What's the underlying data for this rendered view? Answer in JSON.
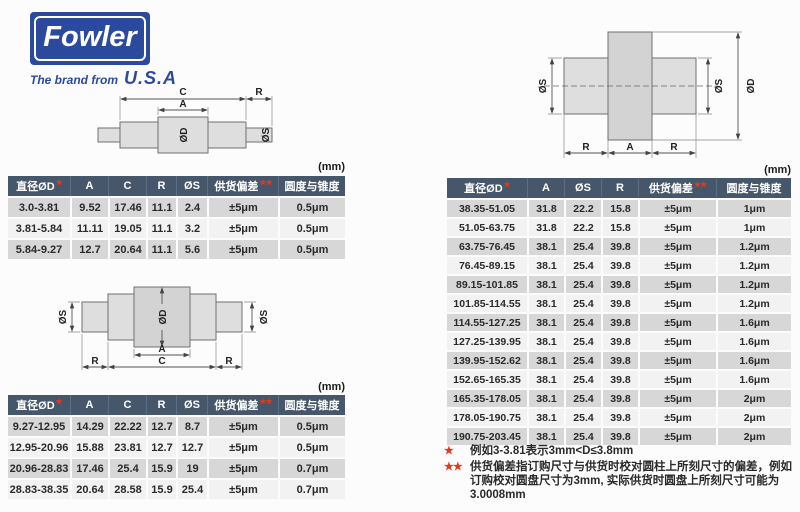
{
  "logo": {
    "brand": "Fowler",
    "tagline_prefix": "The brand from",
    "tagline_suffix": "U.S.A"
  },
  "colors": {
    "logo_blue": "#2b4a9e",
    "table_header_slate": "#46566b",
    "row_gray": "#d7d7d7",
    "row_light": "#f2f2f2",
    "star_red": "#e03a1e"
  },
  "diagrams": {
    "side_small": {
      "labels": {
        "C": "C",
        "A": "A",
        "R": "R",
        "OD": "ØD",
        "OS": "ØS"
      }
    },
    "side_large": {
      "labels": {
        "A": "A",
        "C": "C",
        "R_left": "R",
        "R_right": "R",
        "OD": "ØD",
        "OS_left": "ØS",
        "OS_right": "ØS"
      }
    },
    "front": {
      "labels": {
        "R_left": "R",
        "A": "A",
        "R_right": "R",
        "OD": "ØD",
        "OS_left": "ØS",
        "OS_right": "ØS"
      }
    }
  },
  "tables": {
    "small_upper": {
      "units": "(mm)",
      "headers": [
        {
          "label": "直径ØD",
          "stars": 1
        },
        {
          "label": "A",
          "stars": 0
        },
        {
          "label": "C",
          "stars": 0
        },
        {
          "label": "R",
          "stars": 0
        },
        {
          "label": "ØS",
          "stars": 0
        },
        {
          "label": "供货偏差",
          "stars": 2
        },
        {
          "label": "圆度与锥度",
          "stars": 0
        }
      ],
      "rows": [
        [
          "3.0-3.81",
          "9.52",
          "17.46",
          "11.1",
          "2.4",
          "±5μm",
          "0.5μm"
        ],
        [
          "3.81-5.84",
          "11.11",
          "19.05",
          "11.1",
          "3.2",
          "±5μm",
          "0.5μm"
        ],
        [
          "5.84-9.27",
          "12.7",
          "20.64",
          "11.1",
          "5.6",
          "±5μm",
          "0.5μm"
        ]
      ]
    },
    "small_lower": {
      "units": "(mm)",
      "headers": [
        {
          "label": "直径ØD",
          "stars": 1
        },
        {
          "label": "A",
          "stars": 0
        },
        {
          "label": "C",
          "stars": 0
        },
        {
          "label": "R",
          "stars": 0
        },
        {
          "label": "ØS",
          "stars": 0
        },
        {
          "label": "供货偏差",
          "stars": 2
        },
        {
          "label": "圆度与锥度",
          "stars": 0
        }
      ],
      "rows": [
        [
          "9.27-12.95",
          "14.29",
          "22.22",
          "12.7",
          "8.7",
          "±5μm",
          "0.5μm"
        ],
        [
          "12.95-20.96",
          "15.88",
          "23.81",
          "12.7",
          "12.7",
          "±5μm",
          "0.5μm"
        ],
        [
          "20.96-28.83",
          "17.46",
          "25.4",
          "15.9",
          "19",
          "±5μm",
          "0.7μm"
        ],
        [
          "28.83-38.35",
          "20.64",
          "28.58",
          "15.9",
          "25.4",
          "±5μm",
          "0.7μm"
        ]
      ]
    },
    "large_right": {
      "units": "(mm)",
      "headers": [
        {
          "label": "直径ØD",
          "stars": 1
        },
        {
          "label": "A",
          "stars": 0
        },
        {
          "label": "ØS",
          "stars": 0
        },
        {
          "label": "R",
          "stars": 0
        },
        {
          "label": "供货偏差",
          "stars": 2
        },
        {
          "label": "圆度与锥度",
          "stars": 0
        }
      ],
      "rows": [
        [
          "38.35-51.05",
          "31.8",
          "22.2",
          "15.8",
          "±5μm",
          "1μm"
        ],
        [
          "51.05-63.75",
          "31.8",
          "22.2",
          "15.8",
          "±5μm",
          "1μm"
        ],
        [
          "63.75-76.45",
          "38.1",
          "25.4",
          "39.8",
          "±5μm",
          "1.2μm"
        ],
        [
          "76.45-89.15",
          "38.1",
          "25.4",
          "39.8",
          "±5μm",
          "1.2μm"
        ],
        [
          "89.15-101.85",
          "38.1",
          "25.4",
          "39.8",
          "±5μm",
          "1.2μm"
        ],
        [
          "101.85-114.55",
          "38.1",
          "25.4",
          "39.8",
          "±5μm",
          "1.2μm"
        ],
        [
          "114.55-127.25",
          "38.1",
          "25.4",
          "39.8",
          "±5μm",
          "1.6μm"
        ],
        [
          "127.25-139.95",
          "38.1",
          "25.4",
          "39.8",
          "±5μm",
          "1.6μm"
        ],
        [
          "139.95-152.62",
          "38.1",
          "25.4",
          "39.8",
          "±5μm",
          "1.6μm"
        ],
        [
          "152.65-165.35",
          "38.1",
          "25.4",
          "39.8",
          "±5μm",
          "1.6μm"
        ],
        [
          "165.35-178.05",
          "38.1",
          "25.4",
          "39.8",
          "±5μm",
          "2μm"
        ],
        [
          "178.05-190.75",
          "38.1",
          "25.4",
          "39.8",
          "±5μm",
          "2μm"
        ],
        [
          "190.75-203.45",
          "38.1",
          "25.4",
          "39.8",
          "±5μm",
          "2μm"
        ]
      ]
    }
  },
  "footnotes": [
    {
      "stars": "★",
      "text": "例如3-3.81表示3mm<D≤3.8mm"
    },
    {
      "stars": "★★",
      "text": "供货偏差指订购尺寸与供货时校对圆柱上所刻尺寸的偏差，例如订购校对圆盘尺寸为3mm, 实际供货时圆盘上所刻尺寸可能为3.0008mm"
    }
  ]
}
